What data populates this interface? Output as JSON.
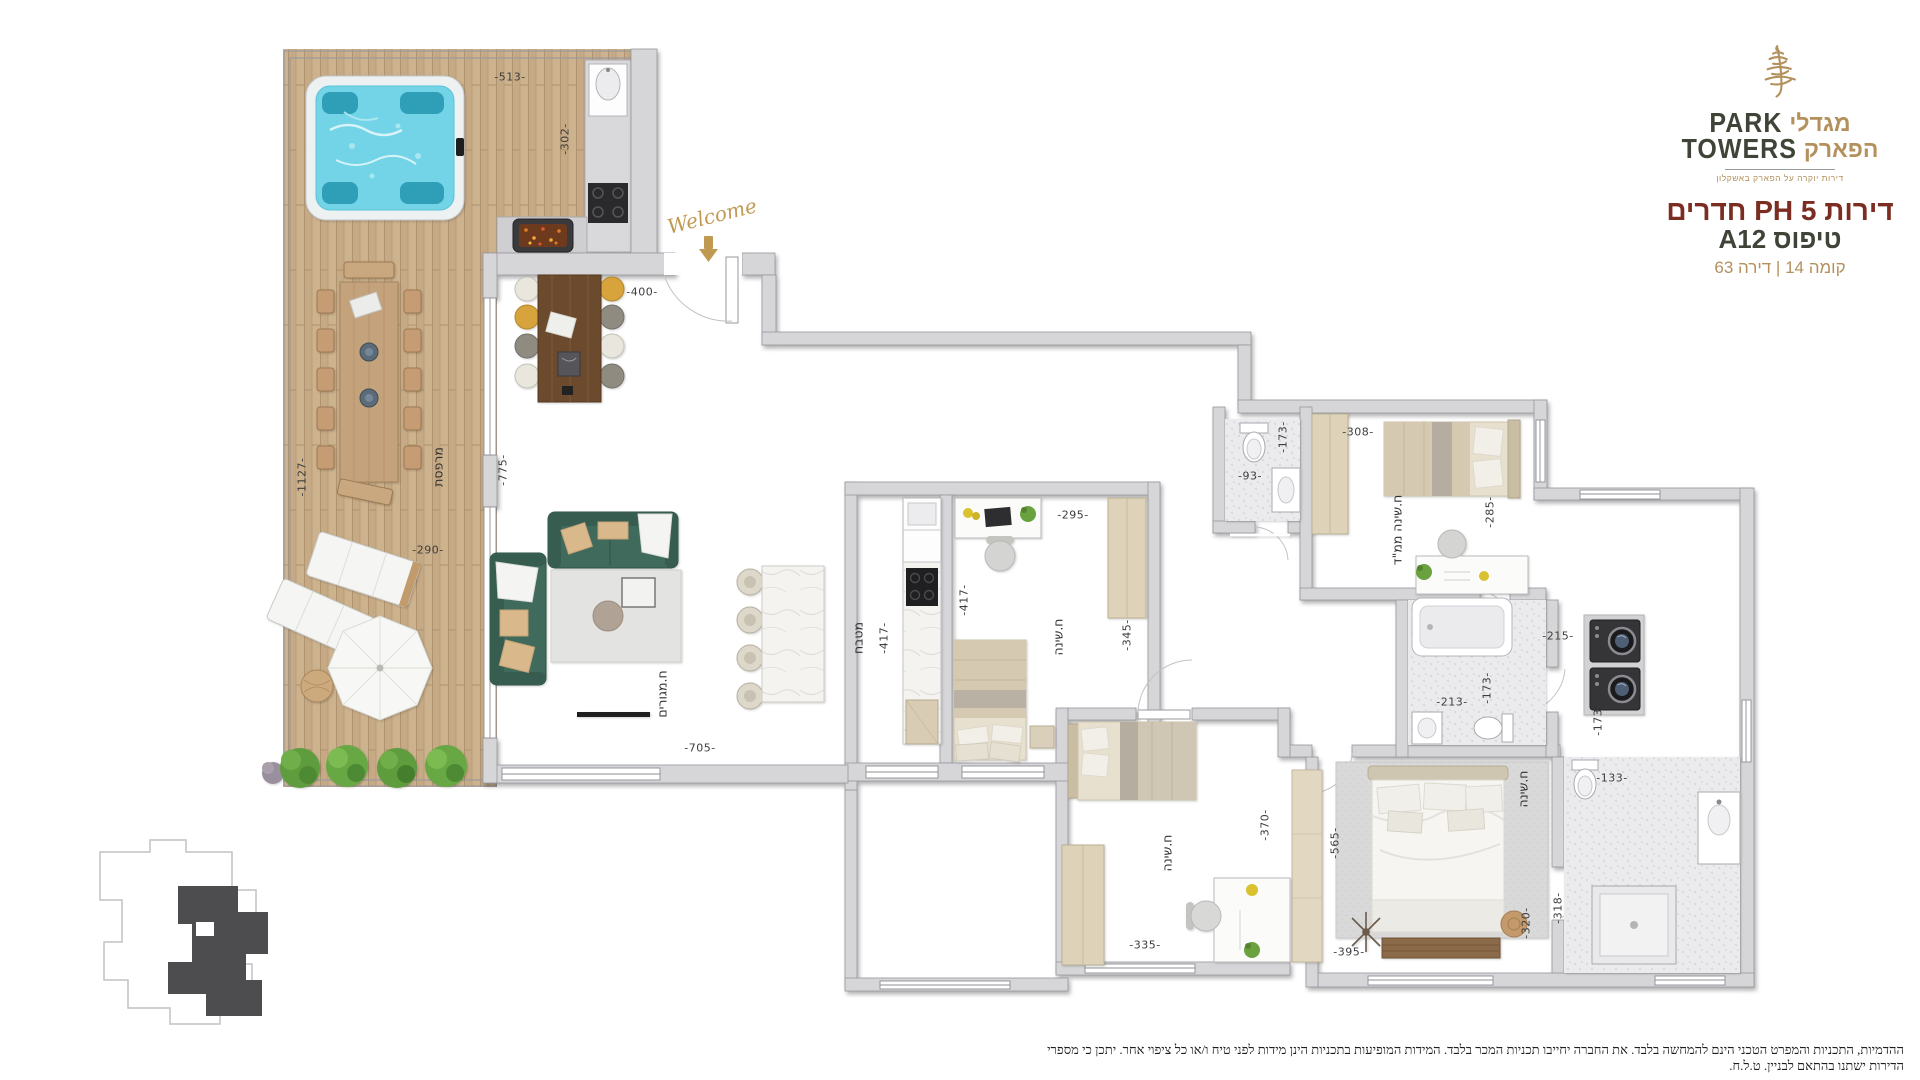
{
  "brand": {
    "hebrew_top": "מגדלי",
    "latin_top": "PARK",
    "hebrew_bottom": "הפארק",
    "latin_bottom": "TOWERS",
    "tagline": "דירות יוקרה על הפארק באשקלון"
  },
  "header": {
    "title": "דירות 5 PH חדרים",
    "type_line": "טיפוס A12",
    "location_line": "קומה 14 | דירה 63"
  },
  "entrance": {
    "script": "Welcome"
  },
  "colors": {
    "gold": "#b3905c",
    "dark_olive": "#3e4437",
    "title_red": "#7c2d21",
    "wall_gray": "#d6d6d9",
    "jacuzzi_water": "#72d4e6",
    "sofa_green": "#3f6a5c",
    "terrace_wood": "#c6aa86"
  },
  "plan": {
    "room_labels": [
      {
        "text": "מרפסת",
        "x": 438,
        "y": 467,
        "v": true
      },
      {
        "text": "ח.מגורים",
        "x": 662,
        "y": 694,
        "v": true
      },
      {
        "text": "מטבח",
        "x": 858,
        "y": 638,
        "v": true
      },
      {
        "text": "ח.שינה",
        "x": 1058,
        "y": 637,
        "v": true
      },
      {
        "text": "ח.שינה ממ\"ד",
        "x": 1397,
        "y": 530,
        "v": true
      },
      {
        "text": "ח.שינה",
        "x": 1167,
        "y": 853,
        "v": true
      },
      {
        "text": "ח.שינה",
        "x": 1523,
        "y": 789,
        "v": true
      }
    ],
    "dimensions": [
      {
        "text": "-513-",
        "x": 510,
        "y": 77,
        "v": false
      },
      {
        "text": "-302-",
        "x": 565,
        "y": 139,
        "v": true
      },
      {
        "text": "-400-",
        "x": 642,
        "y": 292,
        "v": false
      },
      {
        "text": "-1127-",
        "x": 302,
        "y": 477,
        "v": true
      },
      {
        "text": "-775-",
        "x": 503,
        "y": 470,
        "v": true
      },
      {
        "text": "-290-",
        "x": 428,
        "y": 550,
        "v": false
      },
      {
        "text": "-705-",
        "x": 700,
        "y": 748,
        "v": false
      },
      {
        "text": "-417-",
        "x": 884,
        "y": 638,
        "v": true
      },
      {
        "text": "-417-",
        "x": 964,
        "y": 600,
        "v": true
      },
      {
        "text": "-295-",
        "x": 1073,
        "y": 515,
        "v": false
      },
      {
        "text": "-345-",
        "x": 1127,
        "y": 635,
        "v": true
      },
      {
        "text": "-93-",
        "x": 1250,
        "y": 476,
        "v": false
      },
      {
        "text": "-173-",
        "x": 1283,
        "y": 437,
        "v": true
      },
      {
        "text": "-308-",
        "x": 1358,
        "y": 432,
        "v": false
      },
      {
        "text": "-285-",
        "x": 1490,
        "y": 512,
        "v": true
      },
      {
        "text": "-213-",
        "x": 1452,
        "y": 702,
        "v": false
      },
      {
        "text": "-173-",
        "x": 1487,
        "y": 688,
        "v": true
      },
      {
        "text": "-215-",
        "x": 1558,
        "y": 636,
        "v": false
      },
      {
        "text": "-173-",
        "x": 1598,
        "y": 720,
        "v": true
      },
      {
        "text": "-133-",
        "x": 1612,
        "y": 778,
        "v": false
      },
      {
        "text": "-318-",
        "x": 1558,
        "y": 908,
        "v": true
      },
      {
        "text": "-320-",
        "x": 1526,
        "y": 923,
        "v": true
      },
      {
        "text": "-370-",
        "x": 1265,
        "y": 825,
        "v": true
      },
      {
        "text": "-565-",
        "x": 1335,
        "y": 843,
        "v": true
      },
      {
        "text": "-335-",
        "x": 1145,
        "y": 945,
        "v": false
      },
      {
        "text": "-395-",
        "x": 1349,
        "y": 952,
        "v": false
      }
    ]
  },
  "disclaimer": "ההדמיות, התכניות והמפרט הטכני הינם להמחשה בלבד. את החברה יחייבו תכניות המכר בלבד. המידות המופיעות בתכניות הינן מידות לפני טיח ו/או כל ציפוי אחר. יתכן כי מספרי הדירות ישתנו בהתאם לבניין. ט.ל.ח."
}
